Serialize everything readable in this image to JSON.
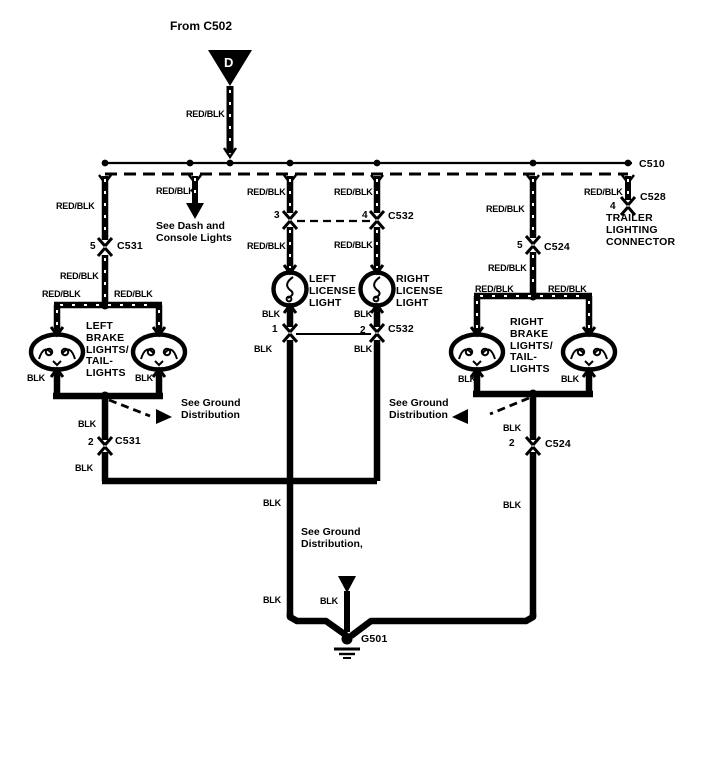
{
  "diagram": {
    "title_note": "From C502",
    "feed_tag": "D",
    "wire_red_blk": "RED/BLK",
    "wire_blk": "BLK",
    "connectors": {
      "c510": "C510",
      "c528": "C528",
      "c531": "C531",
      "c532": "C532",
      "c524": "C524",
      "g501": "G501"
    },
    "pins": {
      "c531_top": "5",
      "c531_bottom": "2",
      "c532_pin3": "3",
      "c532_pin4": "4",
      "c532_pin1": "1",
      "c532_pin2": "2",
      "c524_top": "5",
      "c524_bottom": "2",
      "c528_pin": "4"
    },
    "components": {
      "left_license": "LEFT\nLICENSE\nLIGHT",
      "right_license": "RIGHT\nLICENSE\nLIGHT",
      "left_brake": "LEFT\nBRAKE\nLIGHTS/\nTAIL-\nLIGHTS",
      "right_brake": "RIGHT\nBRAKE\nLIGHTS/\nTAIL-\nLIGHTS",
      "trailer": "TRAILER\nLIGHTING\nCONNECTOR"
    },
    "notes": {
      "dash_console": "See Dash and\nConsole Lights",
      "ground_left": "See Ground\nDistribution",
      "ground_right": "See Ground\nDistribution",
      "ground_bottom": "See Ground\nDistribution,"
    },
    "colors": {
      "ink": "#000000",
      "background": "#ffffff"
    }
  }
}
